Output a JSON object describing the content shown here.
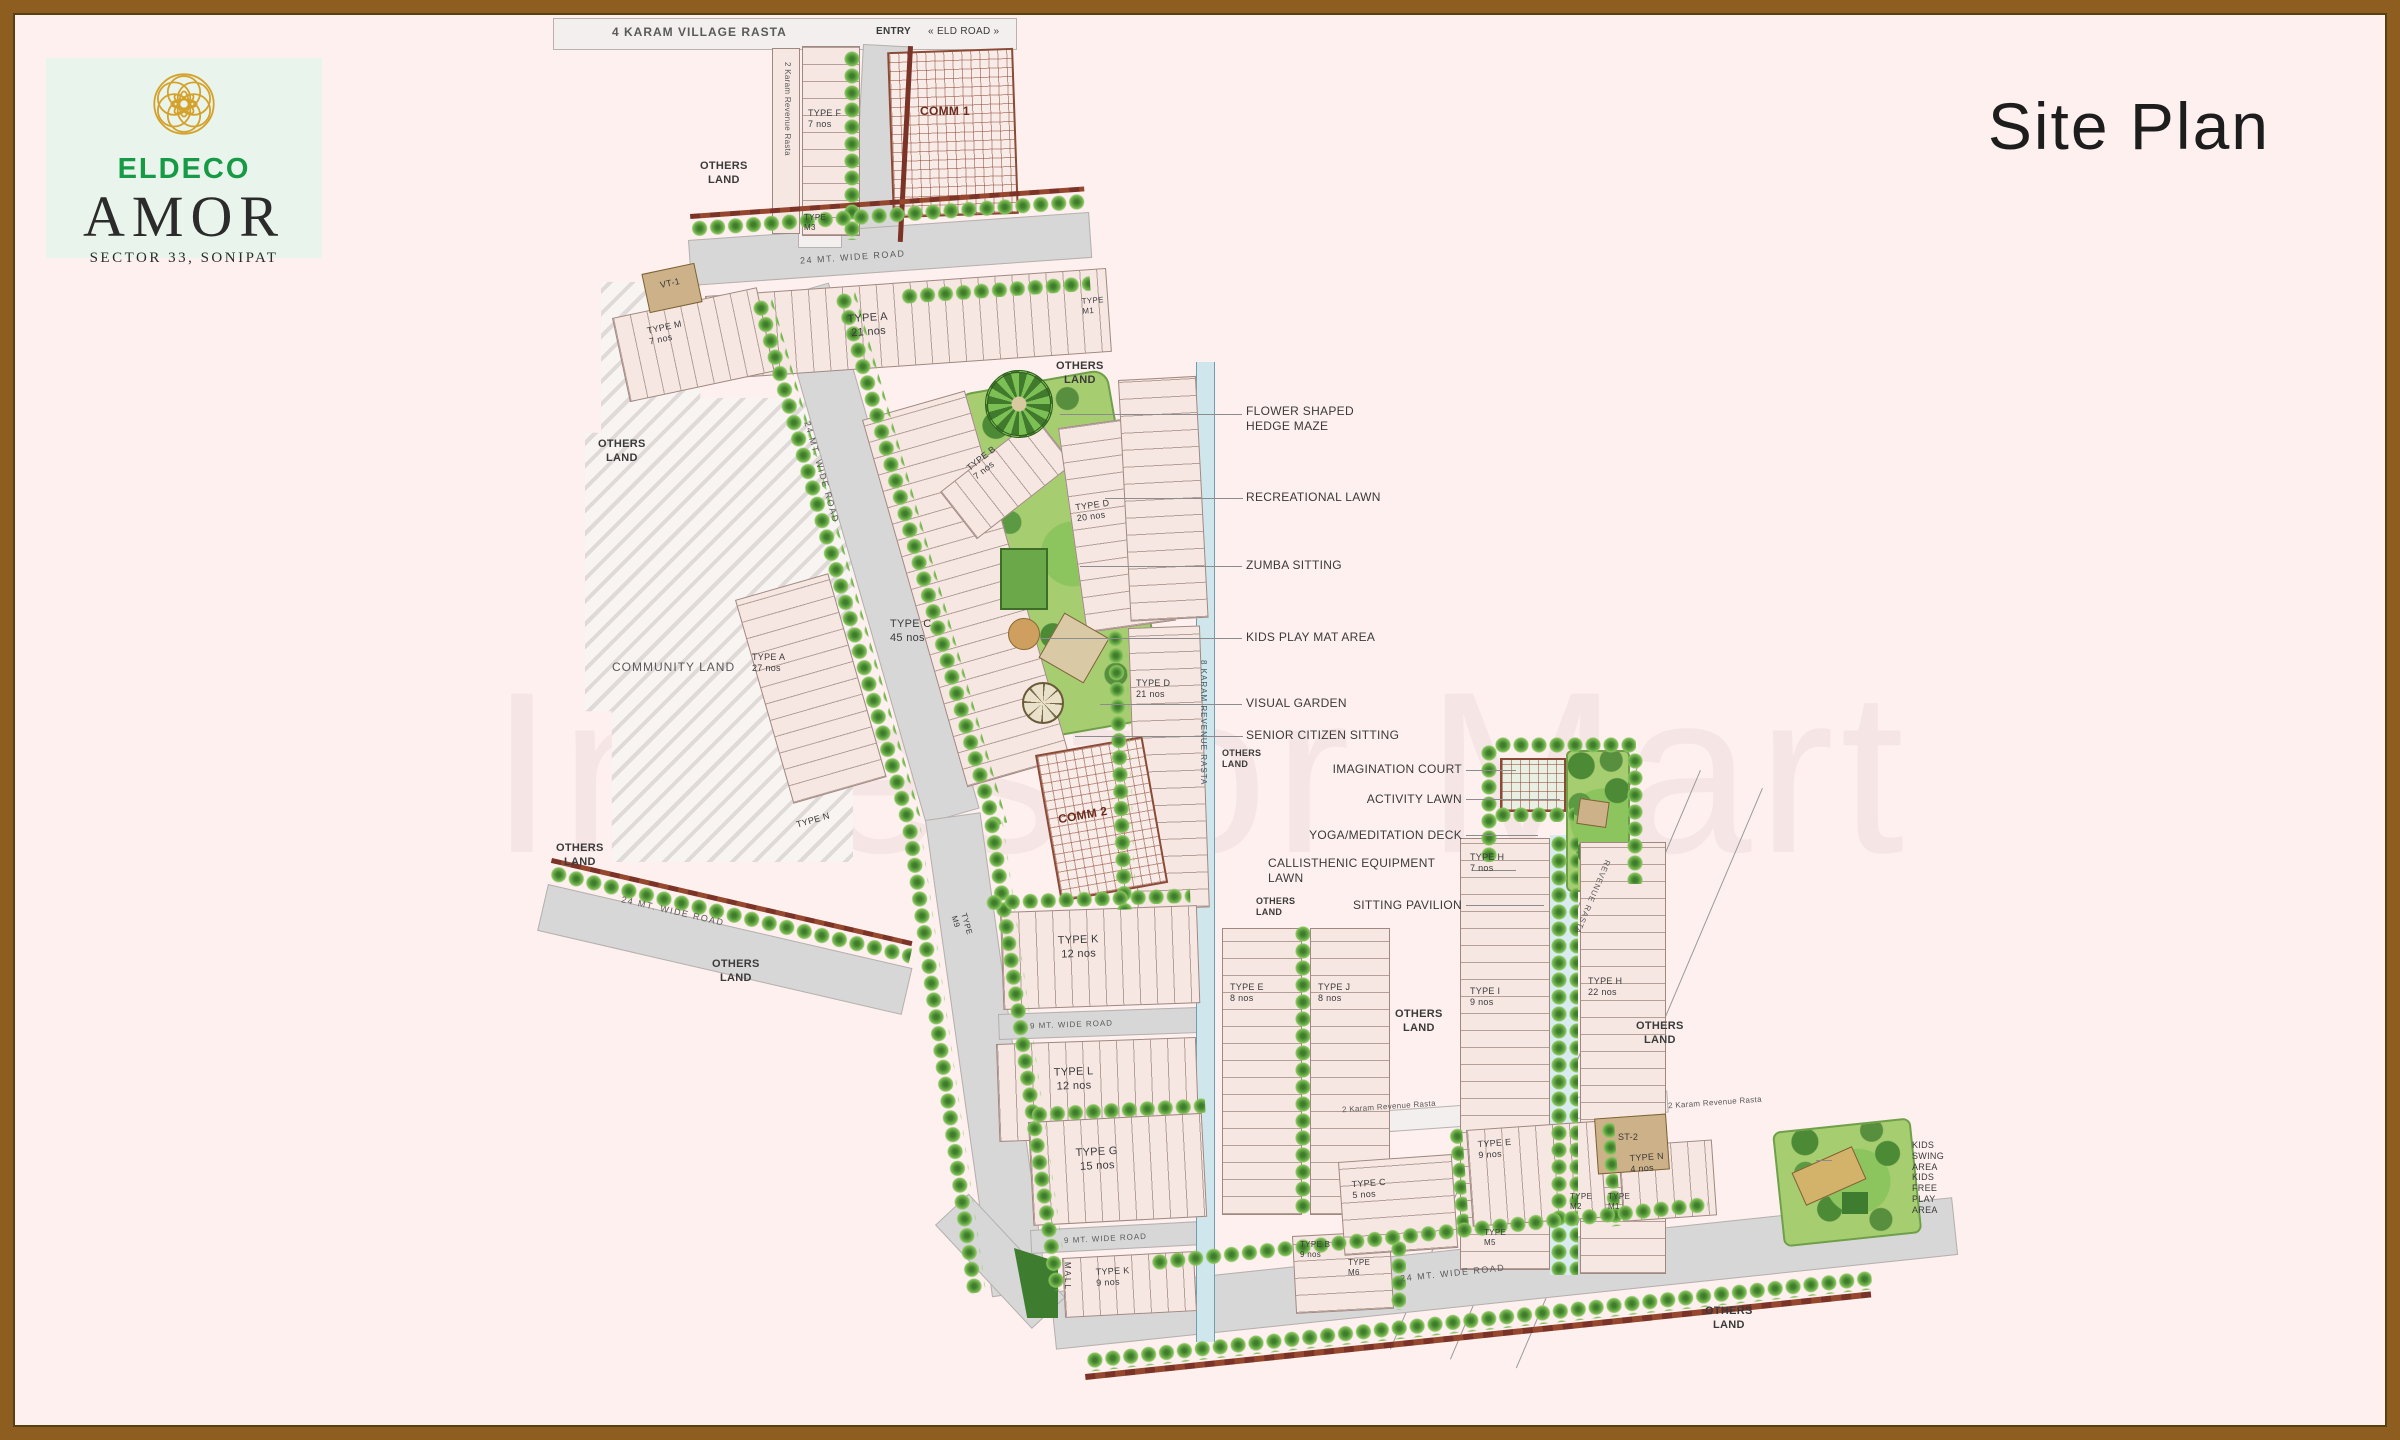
{
  "brand": {
    "developer": "ELDECO",
    "project": "AMOR",
    "location": "SECTOR 33, SONIPAT",
    "logo_icon": "flower-mandala-icon"
  },
  "page_title": "Site Plan",
  "watermark": "Investor Mart",
  "colors": {
    "frame_brown": "#8d5e20",
    "background_pink": "#fdf0ef",
    "logo_gold": "#d4a12a",
    "eldeco_green": "#169a45",
    "road_gray": "#d7d7d7",
    "plot_pink": "#f6e7e3",
    "tree_green": "#63a643",
    "drain_blue": "#cfe7ec",
    "comm_brown": "#8a4a36"
  },
  "labels": {
    "village_rasta": "4 KARAM VILLAGE RASTA",
    "entry": "ENTRY",
    "eld_road": "« ELD ROAD »",
    "comm1": "COMM 1",
    "comm2": "COMM 2",
    "revenue_rasta_vertical": "2 Karam Revenue Rasta",
    "drain_channel": "8 KARAM REVENUE RASTA",
    "revenue_rasta_2k": "2 Karam Revenue Rasta",
    "revenue_rasta_diag": "REVENUE RASTA",
    "road_24": "24 MT. WIDE ROAD",
    "road_9": "9 MT. WIDE ROAD",
    "others_land": "OTHERS\nLAND",
    "community_land": "COMMUNITY LAND",
    "vt1": "VT-1",
    "st2": "ST-2",
    "mall": "MALL",
    "type_f_7": "TYPE F\n7 nos",
    "type_m3": "TYPE\nM3",
    "type_m_7": "TYPE M\n7 nos",
    "type_a_21": "TYPE A\n21 nos",
    "type_m1_top": "TYPE\nM1",
    "type_a_27": "TYPE A\n27 nos",
    "type_n_small": "TYPE N",
    "type_b_7": "TYPE B\n7 nos",
    "type_c_45": "TYPE C\n45 nos",
    "type_d_20": "TYPE D\n20 nos",
    "type_d_21": "TYPE D\n21 nos",
    "type_e_8": "TYPE E\n8 nos",
    "type_j_8": "TYPE J\n8 nos",
    "type_k_12": "TYPE K\n12 nos",
    "type_l_12": "TYPE L\n12 nos",
    "type_m9": "TYPE\nM9",
    "type_g_15": "TYPE G\n15 nos",
    "type_k_9": "TYPE K\n9 nos",
    "type_b_9": "TYPE B\n9 nos",
    "type_m6": "TYPE\nM6",
    "type_m5": "TYPE\nM5",
    "type_h_7": "TYPE H\n7 nos",
    "type_i_9": "TYPE I\n9 nos",
    "type_h_22": "TYPE H\n22 nos",
    "type_c_5": "TYPE C\n5 nos",
    "type_e_9": "TYPE E\n9 nos",
    "type_n_4": "TYPE N\n4 nos",
    "type_m2": "TYPE\nM2",
    "type_m1": "TYPE\nM1",
    "kids_corner": "KIDS\nSWING\nAREA\nKIDS\nFREE\nPLAY\nAREA"
  },
  "amenities_park": {
    "flower_maze": "FLOWER SHAPED\nHEDGE MAZE",
    "recreational_lawn": "RECREATIONAL LAWN",
    "zumba": "ZUMBA SITTING",
    "kids_mat": "KIDS PLAY MAT AREA",
    "visual_garden": "VISUAL GARDEN",
    "senior": "SENIOR CITIZEN SITTING"
  },
  "amenities_activity": {
    "imagination": "IMAGINATION COURT",
    "activity_lawn": "ACTIVITY LAWN",
    "yoga": "YOGA/MEDITATION DECK",
    "callisthenic": "CALLISTHENIC EQUIPMENT\nLAWN",
    "pavilion": "SITTING PAVILION"
  }
}
